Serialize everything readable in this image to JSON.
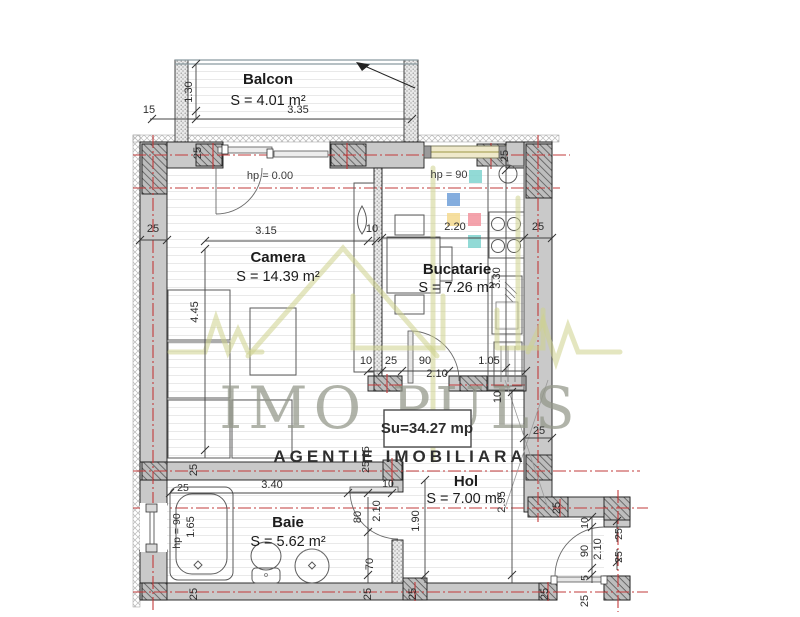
{
  "plan": {
    "rooms": [
      {
        "name": "Balcon",
        "area": "S = 4.01 m²"
      },
      {
        "name": "Camera",
        "area": "S = 14.39 m²"
      },
      {
        "name": "Bucatarie",
        "area": "S = 7.26 m²"
      },
      {
        "name": "Hol",
        "area": "S = 7.00 m²"
      },
      {
        "name": "Baie",
        "area": "S = 5.62 m²"
      }
    ],
    "total_area": "Su=34.27 mp",
    "levels": {
      "balcony_door": "hp =  0.00",
      "kitchen_window": "hp =  90",
      "bath_window": "hp = 90"
    },
    "watermark": {
      "brand": "IMO PULS",
      "tagline": "AGENTIE IMOBILIARA"
    },
    "dims": {
      "d335": "3.35",
      "d130": "1.30",
      "d15": "15",
      "d25": "25",
      "d10": "10",
      "d315": "3.15",
      "d445": "4.45",
      "d220": "2.20",
      "d330": "3.30",
      "d90": "90",
      "d105": "1.05",
      "d210": "2.10",
      "d295": "2.95",
      "d190": "1.90",
      "d340": "3.40",
      "d165": "1.65",
      "d80": "80",
      "d70": "70",
      "d5": "5"
    },
    "colors": {
      "accent_teal": "#7fd4cf",
      "accent_blue": "#6f9fd8",
      "accent_yellow": "#f5d98e",
      "accent_pink": "#f2939e",
      "watermark_green": "#b5cc4a",
      "total_red": "#cc1111",
      "axis_red": "#c23b3b",
      "wall_gray": "#c9c9c9"
    }
  }
}
